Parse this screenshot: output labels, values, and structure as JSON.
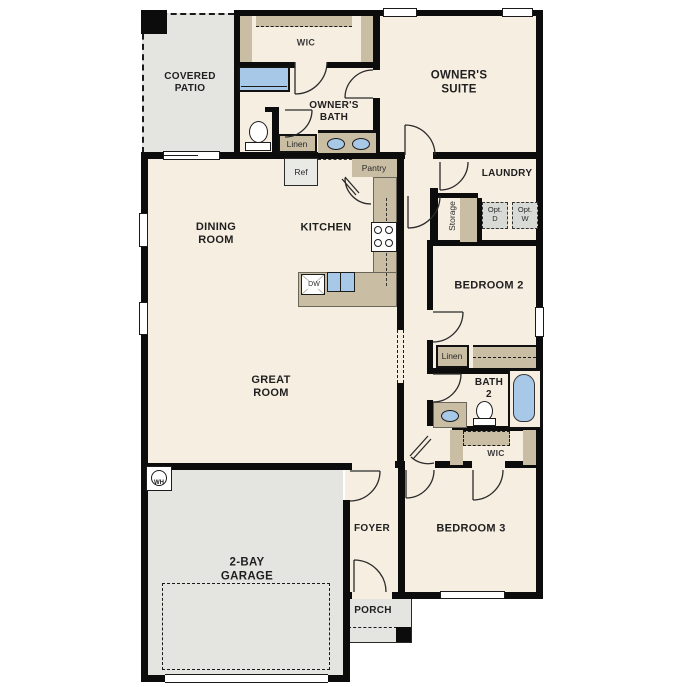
{
  "colors": {
    "floor": "#f6eee1",
    "outdoor": "#e4e5e1",
    "optbox": "#d8dad6",
    "tan": "#c9bda3",
    "blue": "#a8c8e8",
    "wall": "#0c0c0c",
    "ink": "#1f1f1f"
  },
  "rooms": {
    "covered_patio": {
      "label": "COVERED\nPATIO"
    },
    "owners_wic": {
      "label": "WIC"
    },
    "owners_bath": {
      "label": "OWNER'S\nBATH"
    },
    "owners_suite": {
      "label": "OWNER'S\nSUITE"
    },
    "dining_room": {
      "label": "DINING\nROOM"
    },
    "kitchen": {
      "label": "KITCHEN"
    },
    "laundry": {
      "label": "LAUNDRY"
    },
    "bedroom2": {
      "label": "BEDROOM 2"
    },
    "great_room": {
      "label": "GREAT\nROOM"
    },
    "bath2": {
      "label": "BATH\n2"
    },
    "bedroom_wic": {
      "label": "WIC"
    },
    "bedroom3": {
      "label": "BEDROOM 3"
    },
    "foyer": {
      "label": "FOYER"
    },
    "garage": {
      "label": "2-BAY\nGARAGE"
    },
    "porch": {
      "label": "PORCH"
    }
  },
  "fixtures": {
    "linen_owners": "Linen",
    "linen_hall": "Linen",
    "refrigerator": "Ref",
    "pantry": "Pantry",
    "storage": "Storage",
    "opt_dryer": "Opt.\nD",
    "opt_washer": "Opt.\nW",
    "dishwasher": "DW",
    "water_heater": "WH"
  }
}
